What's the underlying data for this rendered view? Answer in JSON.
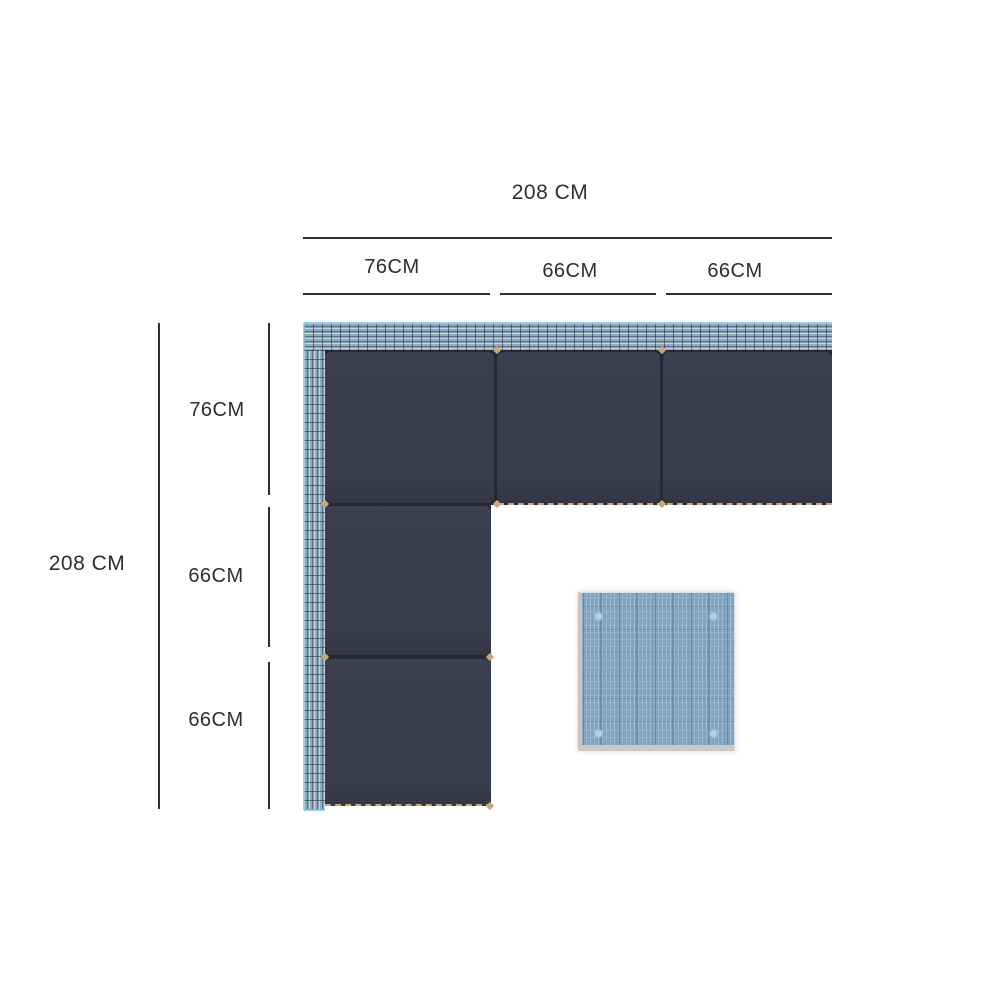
{
  "dimensions": {
    "top": {
      "total": "208 CM",
      "segments": [
        "76CM",
        "66CM",
        "66CM"
      ]
    },
    "left": {
      "total": "208 CM",
      "segments": [
        "76CM",
        "66CM",
        "66CM"
      ]
    }
  },
  "colors": {
    "text": "#2e2e2e",
    "dimension_line": "#2f2f2f",
    "cushion": "#3b3d4e",
    "wicker_light": "#c2d4e0",
    "wicker_mid": "#94abbd",
    "wicker_dark": "#54708a",
    "table_blue": "#7ea4c1",
    "marker_tan": "#c9a77b"
  }
}
